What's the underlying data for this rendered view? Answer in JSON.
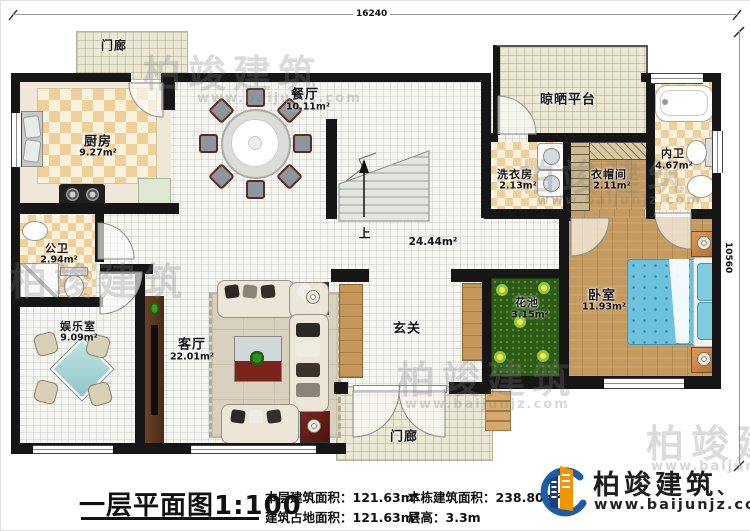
{
  "dimensions": {
    "top": "16240",
    "right": "10560"
  },
  "rooms": [
    {
      "name": "门廊",
      "area": ""
    },
    {
      "name": "厨房",
      "area": "9.27m²"
    },
    {
      "name": "餐厅",
      "area": "10.11m²"
    },
    {
      "name": "公卫",
      "area": "2.94m²"
    },
    {
      "name": "娱乐室",
      "area": "9.09m²"
    },
    {
      "name": "客厅",
      "area": "22.01m²"
    },
    {
      "name": "玄关",
      "area": ""
    },
    {
      "name": "门廊",
      "area": ""
    },
    {
      "name": "花池",
      "area": "3.15m²"
    },
    {
      "name": "卧室",
      "area": "11.93m²"
    },
    {
      "name": "晾晒平台",
      "area": ""
    },
    {
      "name": "洗衣房",
      "area": "2.13m²"
    },
    {
      "name": "衣帽间",
      "area": "2.11m²"
    },
    {
      "name": "内卫",
      "area": "4.67m²"
    }
  ],
  "stairs": {
    "up": "上",
    "hall_area": "24.44m²"
  },
  "footer": {
    "title": "一层平面图",
    "scale": "1:100",
    "stats": [
      {
        "label": "本层建筑面积：",
        "value": "121.63m²"
      },
      {
        "label": "建筑占地面积：",
        "value": "121.63m²"
      },
      {
        "label": "本栋建筑面积：",
        "value": "238.80m²"
      },
      {
        "label": "层高：",
        "value": "3.3m"
      }
    ]
  },
  "logo": {
    "name": "柏竣建筑",
    "mark": "、",
    "url": "www.baijunjz.com"
  },
  "watermark": {
    "text": "柏竣建筑",
    "url": "www.baijunjz.com"
  },
  "colors": {
    "wall": "#161616",
    "checker": "#f0cf98",
    "wood": "#c59a5f",
    "planter_green": "#2d5a16",
    "bed_blue": "#6fc2dd",
    "logo_blue": "#1b5ea6",
    "logo_orange": "#f29400"
  }
}
